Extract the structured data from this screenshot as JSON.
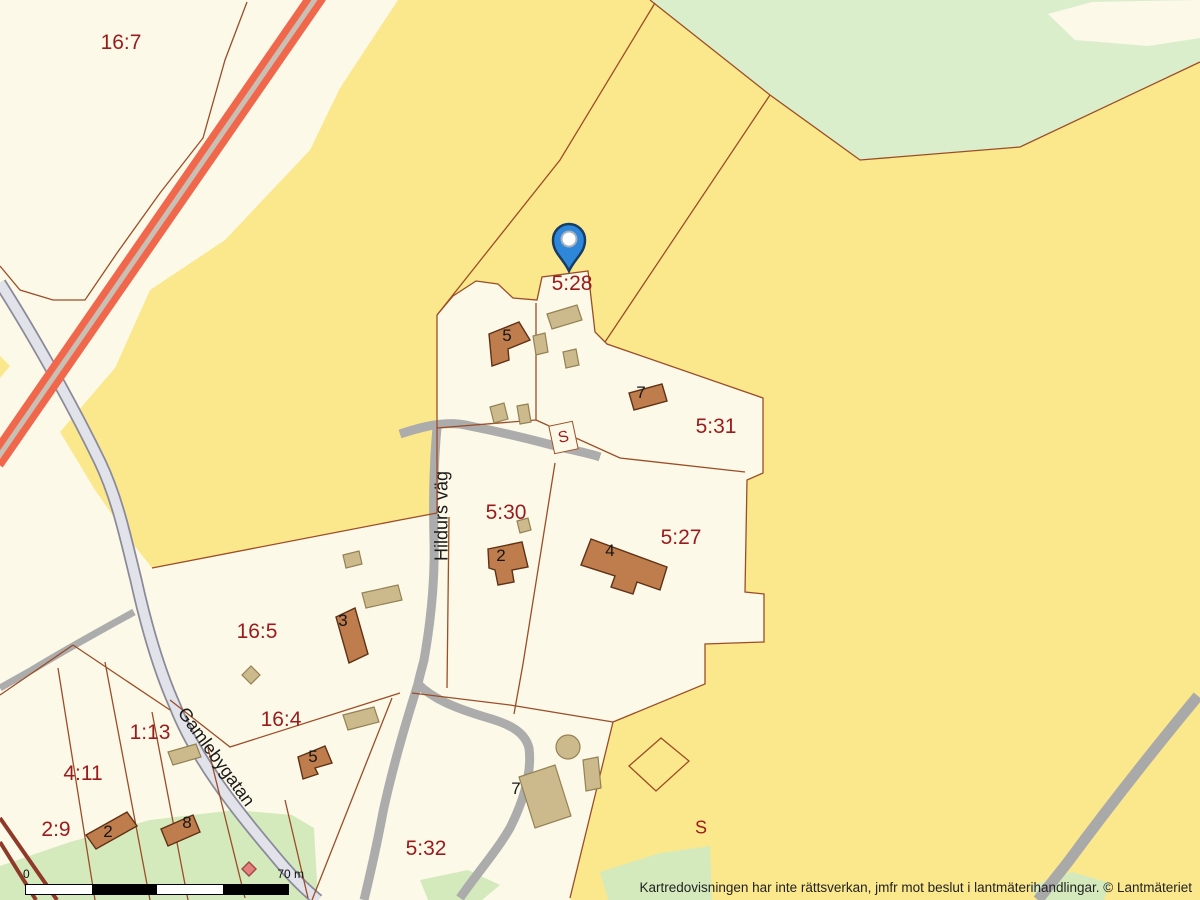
{
  "map": {
    "attribution": "Kartredovisningen har inte rättsverkan, jmfr mot beslut i lantmäterihandlingar. © Lantmäteriet",
    "scale_bar": {
      "start_label": "0",
      "end_label": "70 m"
    },
    "pin": {
      "parcel": "5:28"
    },
    "parcels": {
      "p16_7": "16:7",
      "p5_28": "5:28",
      "p5_31": "5:31",
      "p5_30": "5:30",
      "p5_27": "5:27",
      "p16_5": "16:5",
      "p16_4": "16:4",
      "p1_13": "1:13",
      "p4_11": "4:11",
      "p2_9": "2:9",
      "p5_32": "5:32"
    },
    "streets": {
      "hildurs_vag": "Hildurs väg",
      "gamlebygatan": "Gamlebygatan"
    },
    "building_numbers": {
      "b5_north": "5",
      "b7_north": "7",
      "b2_530": "2",
      "b4_527": "4",
      "b3_165": "3",
      "b5_164": "5",
      "b2_sw": "2",
      "b8_sw": "8",
      "b7_south": "7"
    },
    "symbols": {
      "s_open": "S",
      "s_boxed": "S"
    },
    "colors": {
      "field_yellow": "#FBE88C",
      "parcel_cream": "#FDF9E9",
      "forest_green": "#DBEECC",
      "vegetation_green": "#D4EABD",
      "boundary_brown": "#9C4D26",
      "building_fill": "#BF7C4C",
      "outbuilding_fill": "#CDBA8C",
      "road_gray": "#ACACAC",
      "road_major_fill": "#E2E2EA",
      "railway_orange": "#F1674B",
      "label_red": "#9B1B1B",
      "pin_blue": "#2F87DA"
    }
  }
}
